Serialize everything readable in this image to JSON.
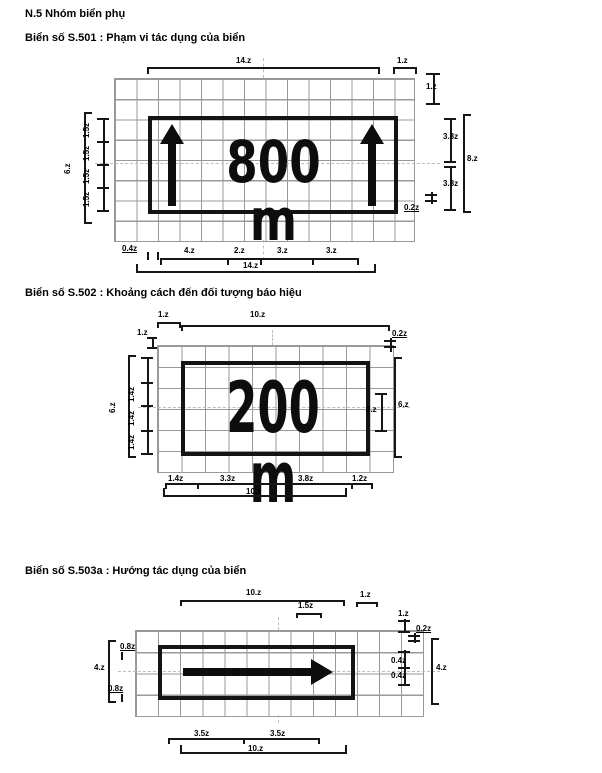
{
  "colors": {
    "ink": "#161616",
    "grid_line": "#999999",
    "centerline": "#bdbdbd",
    "background": "#ffffff"
  },
  "icons": {
    "d1_sign": "up-arrow",
    "d3_sign": "right-arrow"
  },
  "page": {
    "section_title": "N.5 Nhóm biển phụ"
  },
  "d1": {
    "heading": "Biển số S.501 : Phạm vi tác dụng của biển",
    "sign_text": "800 m",
    "dims": {
      "top_width": "14.z",
      "top_right_margin": "1.z",
      "right_margin": "1.z",
      "right_upper": "3.8z",
      "right_total": "8.z",
      "right_lower": "3.8z",
      "right_bottom": "0.2z",
      "left_total": "6.z",
      "left_seg": "1.5z",
      "bottom_offset": "0.4z",
      "b1": "4.z",
      "b2": "2.z",
      "b3": "3.z",
      "b4": "3.z",
      "bottom_total": "14.z"
    }
  },
  "d2": {
    "heading": "Biển số S.502 : Khoảng cách đến đối tượng báo hiệu",
    "sign_text": "200 m",
    "dims": {
      "top_left": "1.z",
      "top_width": "10.z",
      "left_margin": "1.z",
      "right_top": "0.2z",
      "right_text": "2.z",
      "right_total": "6.z",
      "left_total": "6.z",
      "left_seg": "1.4z",
      "b1": "1.4z",
      "b2": "3.3z",
      "b3": "3.8z",
      "b4": "1.2z",
      "bottom_total": "10.z"
    }
  },
  "d3": {
    "heading": "Biển số S.503a : Hướng tác dụng của biển",
    "dims": {
      "top_width": "10.z",
      "arrow_head": "1.5z",
      "top_right": "1.z",
      "right_margin": "1.z",
      "right_top": "0.2z",
      "right_m1": "0.4z",
      "right_m2": "0.4z",
      "right_total": "4.z",
      "left_total": "4.z",
      "left_top": "0.8z",
      "left_bottom": "0.8z",
      "b1": "3.5z",
      "b2": "3.5z",
      "bottom_total": "10.z"
    }
  }
}
